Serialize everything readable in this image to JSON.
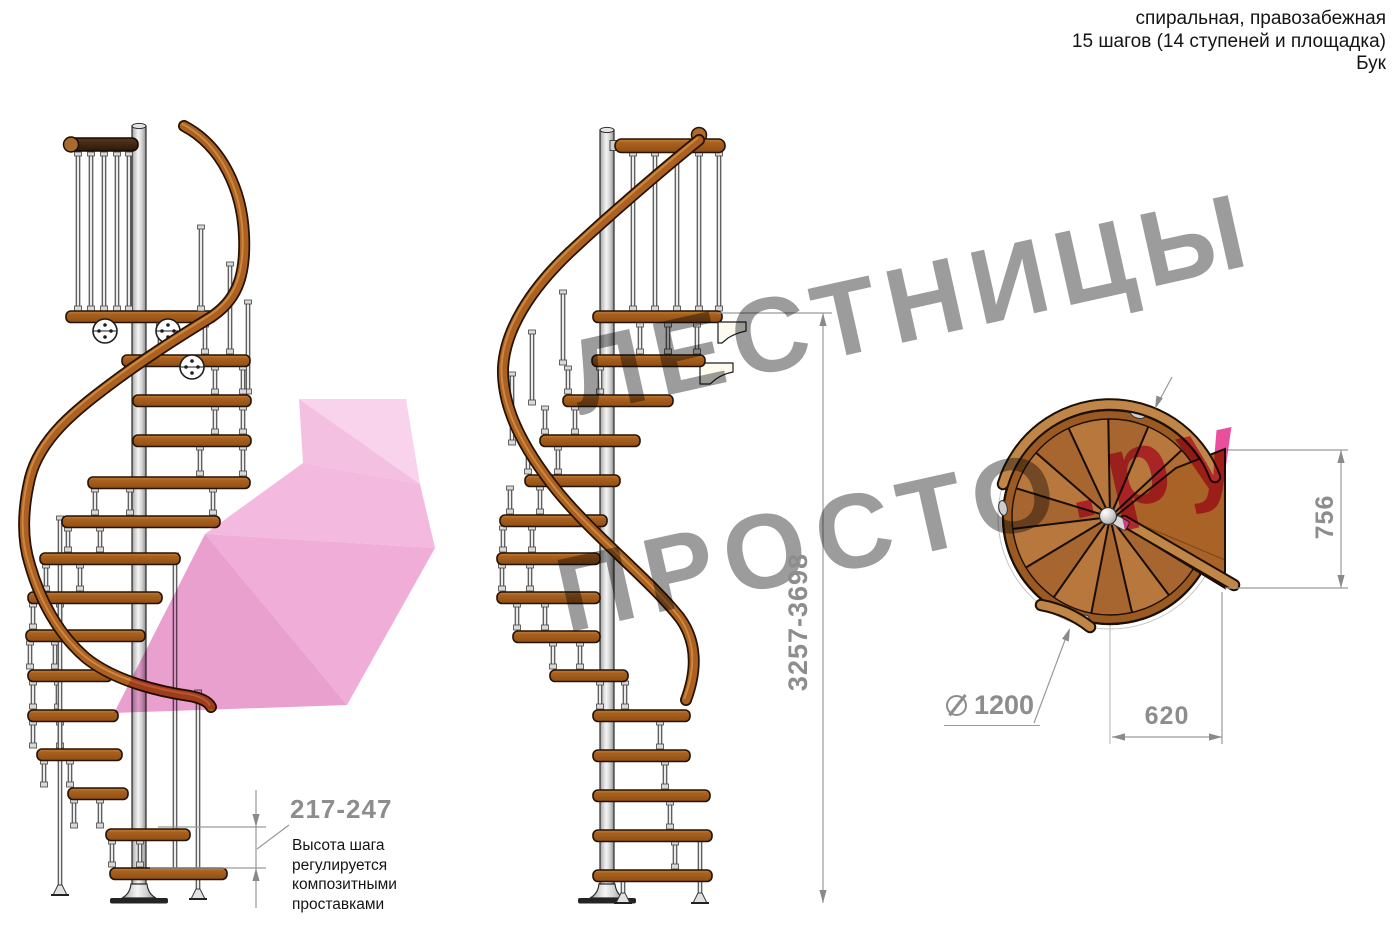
{
  "header": {
    "line1": "спиральная, правозабежная",
    "line2": "15 шагов (14 ступеней и площадка)",
    "line3": "Бук"
  },
  "watermark": {
    "line1": "ЛЕСТНИЦЫ",
    "line2_gray": "ПРОСТО",
    "line2_accent": ".ру"
  },
  "dimensions": {
    "total_height": "3257-3698",
    "landing_depth": "756",
    "plan_width": "620",
    "diameter_value": "1200",
    "diameter_icon": "diameter-icon",
    "step_height": "217-247"
  },
  "note": {
    "text": "Высота шага\nрегулируется\nкомпозитными\nпроставками"
  },
  "colors": {
    "accent": "#ea4f9b",
    "wm": "#9c9c9c",
    "dimline": "#9a9a9a",
    "dimtext": "#8d8d8d",
    "wood": "#a9601d",
    "wood-dark": "#8f4f16",
    "wood-light": "#c5803a",
    "rail": "#ad6120",
    "outline": "#241204",
    "plan-wood": "#b06c33",
    "plan-landing": "#a96327",
    "pole-mid": "#f4f4f4",
    "pole-edge": "#8f8f8f",
    "pink-1": "#f9d2eb",
    "pink-2": "#f4c0e1",
    "pink-3": "#f3b9de",
    "pink-4": "#efadd8",
    "pink-5": "#e9a0cf"
  }
}
